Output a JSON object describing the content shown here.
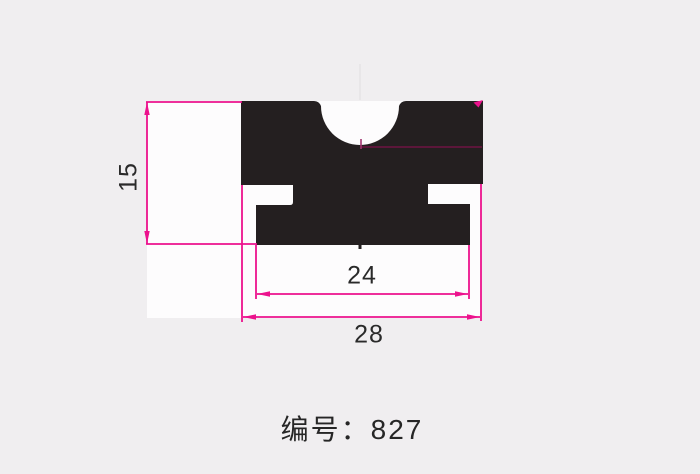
{
  "colors": {
    "background": "#f0eef0",
    "drawing_area": "#fdfcfd",
    "profile": "#241f20",
    "dimension_line": "#ec128d",
    "hidden_centerline": "#7d1049",
    "center_tick": "#a2336f",
    "faint_centerline": "#e3e1e3",
    "label_text": "#2a2a2a"
  },
  "drawing": {
    "height_dim": "15",
    "inner_width_dim": "24",
    "outer_width_dim": "28"
  },
  "footer": {
    "part_number": "编号：827"
  }
}
